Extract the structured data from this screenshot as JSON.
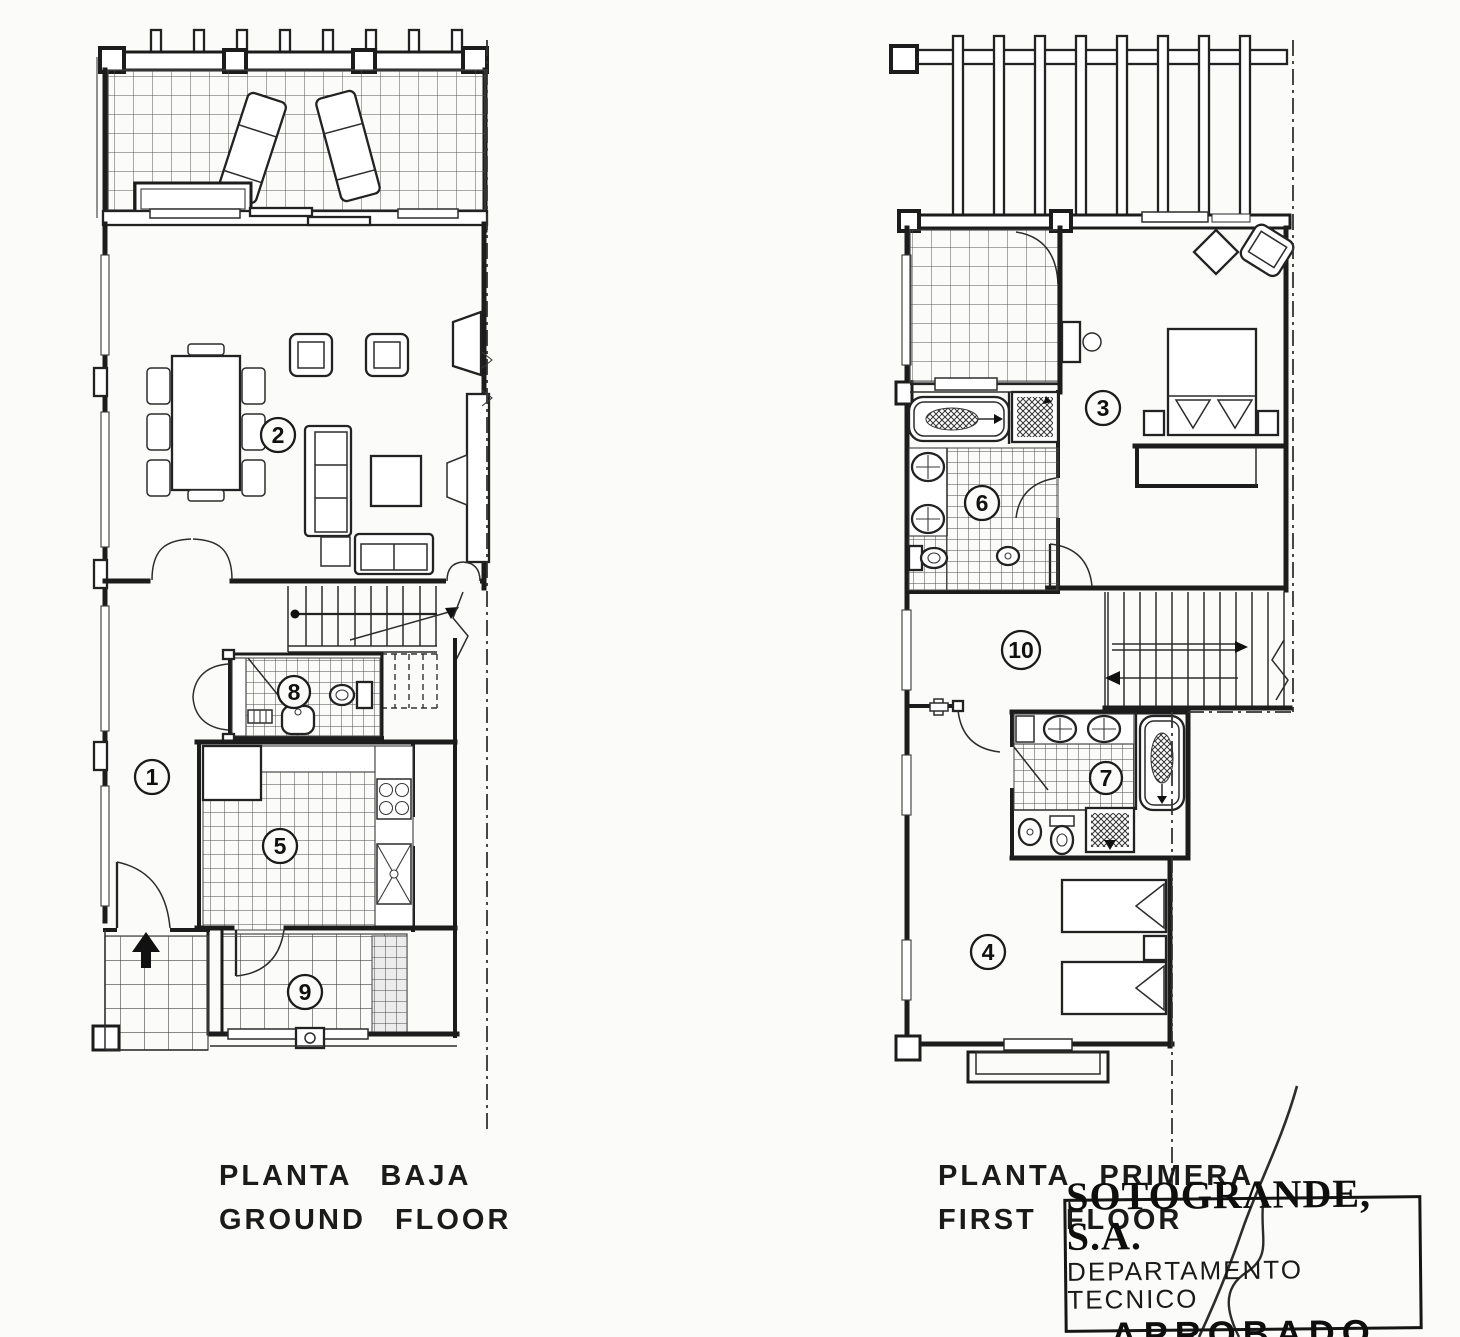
{
  "document": {
    "paper_color": "#fbfbf9",
    "ink_color": "#1c1c1c"
  },
  "ground_floor": {
    "title_es": "PLANTA BAJA",
    "title_en": "GROUND FLOOR",
    "rooms": {
      "hall": "1",
      "living_dining": "2",
      "kitchen": "5",
      "wc": "8",
      "porch": "9"
    }
  },
  "first_floor": {
    "title_es": "PLANTA PRIMERA",
    "title_en": "FIRST FLOOR",
    "rooms": {
      "master_bedroom": "3",
      "bedroom": "4",
      "bathroom": "6",
      "bathroom_2": "7",
      "landing": "10"
    }
  },
  "stamp": {
    "company": "SOTOGRANDE, S.A.",
    "department": "DEPARTAMENTO TECNICO",
    "status": "APROBADO"
  }
}
